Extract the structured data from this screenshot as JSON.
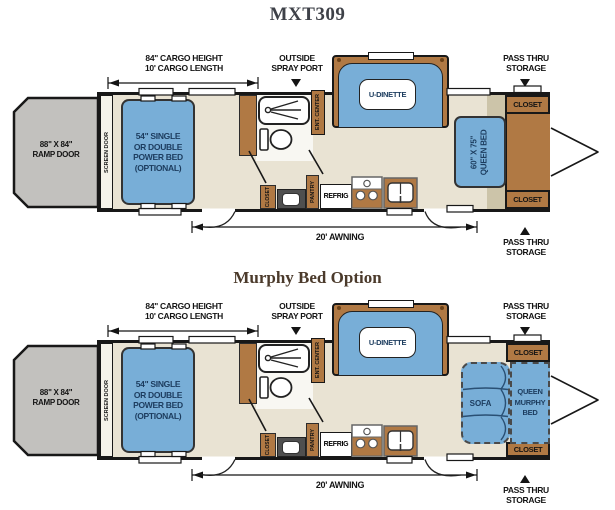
{
  "page_title": "MXT309",
  "murphy_section_title": "Murphy Bed Option",
  "colors": {
    "furniture_blue": "#78AED7",
    "cabinet_brown": "#B07944",
    "floor_beige": "#E9E3D3",
    "ramp_gray": "#C2C1BE",
    "slide_tan": "#CCC4A9",
    "wall_black": "#181818",
    "bed_text_navy": "#1C3C5E"
  },
  "plans": [
    {
      "variant": "standard",
      "cargo_height": "84\" CARGO HEIGHT",
      "cargo_length": "10' CARGO LENGTH",
      "outside_spray_line1": "OUTSIDE",
      "outside_spray_line2": "SPRAY PORT",
      "pass_thru_top_line1": "PASS THRU",
      "pass_thru_top_line2": "STORAGE",
      "pass_thru_bottom_line1": "PASS THRU",
      "pass_thru_bottom_line2": "STORAGE",
      "ramp_door_line1": "88\" X 84\"",
      "ramp_door_line2": "RAMP DOOR",
      "screen_door": "SCREEN DOOR",
      "power_bed_line1": "54\" SINGLE",
      "power_bed_line2": "OR DOUBLE",
      "power_bed_line3": "POWER BED",
      "power_bed_line4": "(OPTIONAL)",
      "u_dinette": "U-DINETTE",
      "ent_center": "ENT. CENTER",
      "bath_closet": "CLOSET",
      "pantry": "PANTRY",
      "refrig": "REFRIG",
      "awning": "20' AWNING",
      "queen_bed_line1": "60\" X 75\"",
      "queen_bed_line2": "QUEEN BED",
      "closet_top": "CLOSET",
      "closet_bottom": "CLOSET"
    },
    {
      "variant": "murphy",
      "cargo_height": "84\" CARGO HEIGHT",
      "cargo_length": "10' CARGO LENGTH",
      "outside_spray_line1": "OUTSIDE",
      "outside_spray_line2": "SPRAY PORT",
      "pass_thru_top_line1": "PASS THRU",
      "pass_thru_top_line2": "STORAGE",
      "pass_thru_bottom_line1": "PASS THRU",
      "pass_thru_bottom_line2": "STORAGE",
      "ramp_door_line1": "88\" X 84\"",
      "ramp_door_line2": "RAMP DOOR",
      "screen_door": "SCREEN DOOR",
      "power_bed_line1": "54\" SINGLE",
      "power_bed_line2": "OR DOUBLE",
      "power_bed_line3": "POWER BED",
      "power_bed_line4": "(OPTIONAL)",
      "u_dinette": "U-DINETTE",
      "ent_center": "ENT. CENTER",
      "bath_closet": "CLOSET",
      "pantry": "PANTRY",
      "refrig": "REFRIG",
      "awning": "20' AWNING",
      "sofa": "SOFA",
      "murphy_bed_line1": "QUEEN",
      "murphy_bed_line2": "MURPHY",
      "murphy_bed_line3": "BED",
      "closet_top": "CLOSET",
      "closet_bottom": "CLOSET"
    }
  ]
}
